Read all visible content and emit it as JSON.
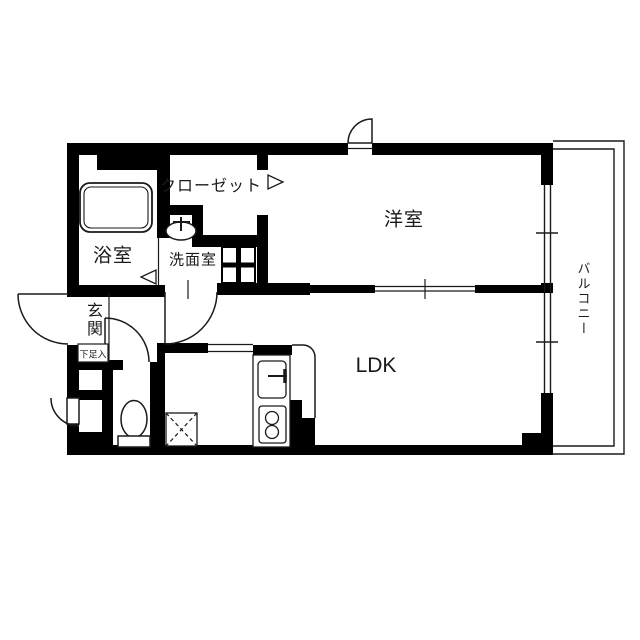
{
  "floorplan": {
    "rooms": {
      "closet": {
        "label": "クローゼット"
      },
      "bathroom": {
        "label": "浴室"
      },
      "washroom": {
        "label": "洗面室"
      },
      "western_room": {
        "label": "洋室"
      },
      "ldk": {
        "label": "LDK"
      },
      "entrance": {
        "label": "玄関"
      },
      "shoe_cabinet": {
        "label": "下足入"
      },
      "balcony": {
        "label": "バルコニー"
      }
    },
    "fixtures": [
      "bathtub-icon",
      "washbasin-icon",
      "washing-machine-pan-icon",
      "toilet-icon",
      "refrigerator-space-icon",
      "kitchen-sink-icon",
      "stove-icon",
      "door-swing-icon",
      "entry-arrow-icon"
    ],
    "colors": {
      "wall": "#000000",
      "floor": "#ffffff",
      "line": "#1a1a1a"
    }
  }
}
